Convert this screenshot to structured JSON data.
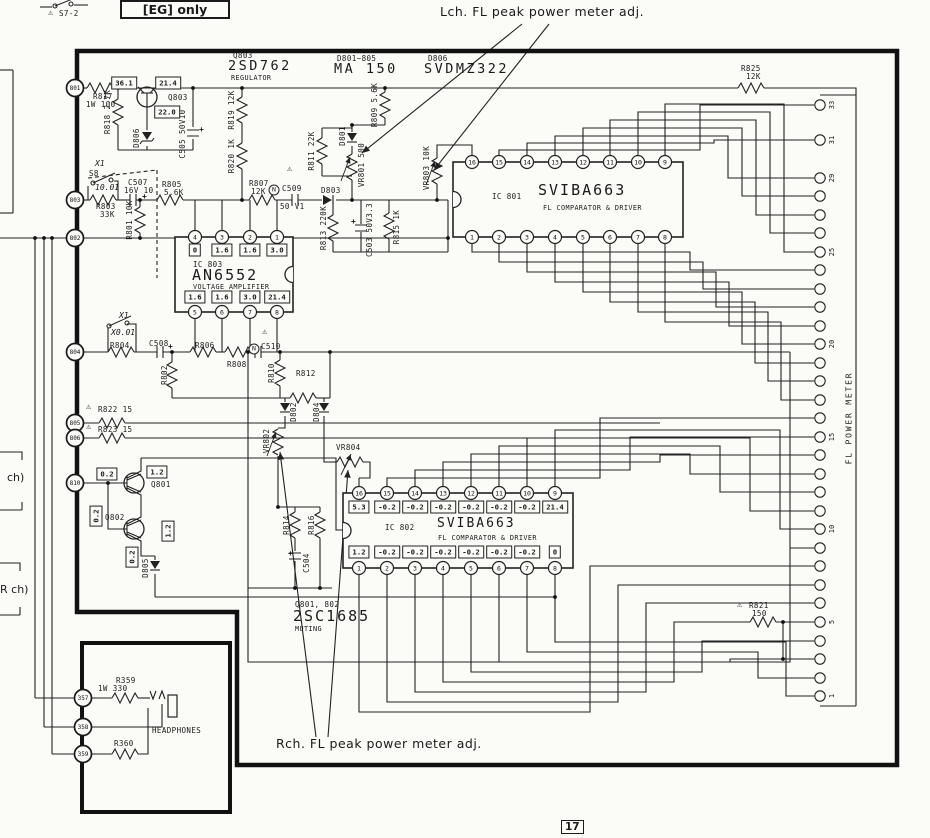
{
  "annotations": {
    "lch": "Lch. FL peak power meter adj.",
    "rch": "Rch. FL peak power meter adj.",
    "eg_only": "[EG] only",
    "page": "17"
  },
  "labels": [
    {
      "t": "⚠",
      "x": 48,
      "y": 9,
      "c": "w",
      "n": "warn-s7-icon"
    },
    {
      "t": "S7-2",
      "x": 59,
      "y": 10,
      "c": "s",
      "n": "switch-s7-2-label"
    },
    {
      "t": "Q803",
      "x": 233,
      "y": 52,
      "c": "s",
      "n": "q803-ref"
    },
    {
      "t": "2SD762",
      "x": 228,
      "y": 59,
      "c": "b1",
      "n": "q803-part"
    },
    {
      "t": "REGULATOR",
      "x": 231,
      "y": 75,
      "c": "xs",
      "n": "q803-function"
    },
    {
      "t": "D801~805",
      "x": 337,
      "y": 55,
      "c": "s",
      "n": "d801-805-ref"
    },
    {
      "t": "MA 150",
      "x": 334,
      "y": 62,
      "c": "b1",
      "n": "d801-805-part"
    },
    {
      "t": "D806",
      "x": 428,
      "y": 55,
      "c": "s",
      "n": "d806-ref"
    },
    {
      "t": "SVDMZ322",
      "x": 424,
      "y": 62,
      "c": "b1",
      "n": "d806-part"
    },
    {
      "t": "R825",
      "x": 741,
      "y": 65,
      "c": "s"
    },
    {
      "t": "12K",
      "x": 746,
      "y": 73,
      "c": "s"
    },
    {
      "t": "R817",
      "x": 93,
      "y": 93,
      "c": "s"
    },
    {
      "t": "1W 100",
      "x": 86,
      "y": 101,
      "c": "s"
    },
    {
      "t": "Q803",
      "x": 168,
      "y": 94,
      "c": "s"
    },
    {
      "t": "R818 2.7K",
      "x": 108,
      "y": 112,
      "r": 1
    },
    {
      "t": "D806",
      "x": 137,
      "y": 138,
      "r": 1
    },
    {
      "t": "C505 50V10",
      "x": 183,
      "y": 134,
      "r": 1
    },
    {
      "t": "R819 12K",
      "x": 232,
      "y": 110,
      "r": 1
    },
    {
      "t": "R820 1K",
      "x": 232,
      "y": 156,
      "r": 1
    },
    {
      "t": "⚠",
      "x": 287,
      "y": 165,
      "c": "w"
    },
    {
      "t": "R811 22K",
      "x": 312,
      "y": 151,
      "r": 1
    },
    {
      "t": "D801",
      "x": 343,
      "y": 136,
      "r": 1
    },
    {
      "t": "R809 5.6K",
      "x": 375,
      "y": 105,
      "r": 1
    },
    {
      "t": "VR801 500",
      "x": 362,
      "y": 165,
      "r": 1
    },
    {
      "t": "VR803 10K",
      "x": 427,
      "y": 168,
      "r": 1
    },
    {
      "t": "X1",
      "x": 95,
      "y": 160,
      "c": "si"
    },
    {
      "t": "S8",
      "x": 89,
      "y": 170,
      "c": "s"
    },
    {
      "t": "10.01",
      "x": 95,
      "y": 184,
      "c": "si"
    },
    {
      "t": "C507",
      "x": 128,
      "y": 179,
      "c": "s"
    },
    {
      "t": "16V 10",
      "x": 124,
      "y": 187,
      "c": "s"
    },
    {
      "t": "R803",
      "x": 96,
      "y": 203,
      "c": "s"
    },
    {
      "t": "33K",
      "x": 100,
      "y": 211,
      "c": "s"
    },
    {
      "t": "R801 10K",
      "x": 130,
      "y": 220,
      "r": 1
    },
    {
      "t": "R805",
      "x": 162,
      "y": 181,
      "c": "s"
    },
    {
      "t": "5.6K",
      "x": 164,
      "y": 189,
      "c": "s"
    },
    {
      "t": "R807",
      "x": 249,
      "y": 180,
      "c": "s"
    },
    {
      "t": "12K",
      "x": 251,
      "y": 188,
      "c": "s"
    },
    {
      "t": "C509",
      "x": 282,
      "y": 185,
      "c": "s"
    },
    {
      "t": "50 V1",
      "x": 280,
      "y": 203,
      "c": "s"
    },
    {
      "t": "D803",
      "x": 321,
      "y": 187,
      "c": "s"
    },
    {
      "t": "R813 220K",
      "x": 324,
      "y": 228,
      "r": 1
    },
    {
      "t": "C503 50V3.3",
      "x": 370,
      "y": 230,
      "r": 1
    },
    {
      "t": "R815 1K",
      "x": 397,
      "y": 227,
      "r": 1
    },
    {
      "t": "IC 803",
      "x": 193,
      "y": 261,
      "c": "s",
      "n": "ic803-ref"
    },
    {
      "t": "AN6552",
      "x": 192,
      "y": 268,
      "c": "b2",
      "n": "ic803-part"
    },
    {
      "t": "VOLTAGE AMPLIFIER",
      "x": 193,
      "y": 284,
      "c": "xs",
      "n": "ic803-function"
    },
    {
      "t": "X1",
      "x": 119,
      "y": 312,
      "c": "si"
    },
    {
      "t": "X0.01",
      "x": 111,
      "y": 329,
      "c": "si"
    },
    {
      "t": "R804",
      "x": 110,
      "y": 342,
      "c": "s"
    },
    {
      "t": "C508",
      "x": 149,
      "y": 340,
      "c": "s"
    },
    {
      "t": "R806",
      "x": 195,
      "y": 342,
      "c": "s"
    },
    {
      "t": "R808",
      "x": 227,
      "y": 361,
      "c": "s"
    },
    {
      "t": "⚠",
      "x": 262,
      "y": 328,
      "c": "w"
    },
    {
      "t": "C510",
      "x": 261,
      "y": 343,
      "c": "s"
    },
    {
      "t": "R802",
      "x": 165,
      "y": 375,
      "r": 1
    },
    {
      "t": "R810",
      "x": 272,
      "y": 373,
      "r": 1
    },
    {
      "t": "R812",
      "x": 296,
      "y": 370,
      "c": "s"
    },
    {
      "t": "⚠",
      "x": 86,
      "y": 403,
      "c": "w"
    },
    {
      "t": "R822 15",
      "x": 98,
      "y": 406,
      "c": "s"
    },
    {
      "t": "⚠",
      "x": 86,
      "y": 423,
      "c": "w"
    },
    {
      "t": "R823 15",
      "x": 98,
      "y": 426,
      "c": "s"
    },
    {
      "t": "VR802",
      "x": 267,
      "y": 441,
      "r": 1
    },
    {
      "t": "D802",
      "x": 294,
      "y": 412,
      "r": 1
    },
    {
      "t": "D804",
      "x": 317,
      "y": 412,
      "r": 1
    },
    {
      "t": "VR804",
      "x": 336,
      "y": 444,
      "c": "s"
    },
    {
      "t": "Q801",
      "x": 151,
      "y": 481,
      "c": "s"
    },
    {
      "t": "Q802",
      "x": 105,
      "y": 514,
      "c": "s"
    },
    {
      "t": "D805",
      "x": 146,
      "y": 568,
      "r": 1
    },
    {
      "t": "R814",
      "x": 287,
      "y": 525,
      "r": 1
    },
    {
      "t": "R816",
      "x": 312,
      "y": 525,
      "r": 1
    },
    {
      "t": "C504",
      "x": 307,
      "y": 563,
      "r": 1
    },
    {
      "t": "Q801, 802",
      "x": 295,
      "y": 601,
      "c": "s",
      "n": "q801-802-ref"
    },
    {
      "t": "2SC1685",
      "x": 293,
      "y": 609,
      "c": "b2",
      "n": "q801-802-part"
    },
    {
      "t": "MUTING",
      "x": 295,
      "y": 626,
      "c": "xs",
      "n": "q801-802-function"
    },
    {
      "t": "IC 801",
      "x": 492,
      "y": 193,
      "c": "s",
      "n": "ic801-ref"
    },
    {
      "t": "SVIBA663",
      "x": 538,
      "y": 183,
      "c": "b2",
      "n": "ic801-part"
    },
    {
      "t": "FL COMPARATOR & DRIVER",
      "x": 543,
      "y": 205,
      "c": "xs",
      "n": "ic801-function"
    },
    {
      "t": "IC 802",
      "x": 385,
      "y": 524,
      "c": "s",
      "n": "ic802-ref"
    },
    {
      "t": "SVIBA663",
      "x": 437,
      "y": 517,
      "c": "b3",
      "n": "ic802-part"
    },
    {
      "t": "FL COMPARATOR & DRIVER",
      "x": 438,
      "y": 535,
      "c": "xs",
      "n": "ic802-function"
    },
    {
      "t": "⚠",
      "x": 737,
      "y": 601,
      "c": "w"
    },
    {
      "t": "R821",
      "x": 749,
      "y": 602,
      "c": "s"
    },
    {
      "t": "150",
      "x": 752,
      "y": 610,
      "c": "s"
    },
    {
      "t": "R359",
      "x": 116,
      "y": 677,
      "c": "s"
    },
    {
      "t": "1W 330",
      "x": 98,
      "y": 685,
      "c": "s"
    },
    {
      "t": "R360",
      "x": 114,
      "y": 740,
      "c": "s"
    },
    {
      "t": "HEADPHONES",
      "x": 152,
      "y": 727,
      "c": "s",
      "n": "headphones-label"
    },
    {
      "t": "ch)",
      "x": 7,
      "y": 472,
      "c": "a2",
      "n": "lch-partial-label"
    },
    {
      "t": "R ch)",
      "x": 0,
      "y": 584,
      "c": "a2",
      "n": "rch-partial-label"
    }
  ],
  "boxed_values": [
    {
      "t": "36.1",
      "x": 124,
      "y": 83
    },
    {
      "t": "21.4",
      "x": 168,
      "y": 83
    },
    {
      "t": "22.0",
      "x": 167,
      "y": 112
    },
    {
      "t": "0.2",
      "x": 107,
      "y": 474
    },
    {
      "t": "1.2",
      "x": 157,
      "y": 472
    },
    {
      "t": "0.2",
      "x": 96,
      "y": 516,
      "rot": 1
    },
    {
      "t": "1.2",
      "x": 168,
      "y": 531,
      "rot": 1
    },
    {
      "t": "0.2",
      "x": 132,
      "y": 557,
      "rot": 1
    }
  ],
  "circle_n_marks": [
    {
      "x": 274,
      "y": 190,
      "t": "N"
    },
    {
      "x": 254,
      "y": 349,
      "t": "N"
    }
  ],
  "plus_marks": [
    [
      142,
      192
    ],
    [
      199,
      125
    ],
    [
      168,
      342
    ],
    [
      351,
      217
    ],
    [
      288,
      549
    ]
  ],
  "left_pins": [
    {
      "id": "801",
      "x": 75,
      "y": 88
    },
    {
      "id": "803",
      "x": 75,
      "y": 200
    },
    {
      "id": "802",
      "x": 75,
      "y": 238
    },
    {
      "id": "804",
      "x": 75,
      "y": 352
    },
    {
      "id": "805",
      "x": 75,
      "y": 423
    },
    {
      "id": "806",
      "x": 75,
      "y": 438
    },
    {
      "id": "810",
      "x": 75,
      "y": 483
    },
    {
      "id": "357",
      "x": 83,
      "y": 698
    },
    {
      "id": "358",
      "x": 83,
      "y": 727
    },
    {
      "id": "359",
      "x": 83,
      "y": 754
    }
  ],
  "ics": [
    {
      "id": "ic803",
      "box": [
        175,
        237,
        293,
        312
      ],
      "notch": "right",
      "xs": [
        195,
        222,
        250,
        277
      ],
      "pins_top": [
        "4",
        "3",
        "2",
        "1"
      ],
      "pins_bottom": [
        "5",
        "6",
        "7",
        "8"
      ],
      "vals_top": [
        "0",
        "1.6",
        "1.6",
        "3.0"
      ],
      "vals_bottom": [
        "1.6",
        "1.6",
        "3.0",
        "21.4"
      ],
      "val_y_top": 250,
      "val_y_bottom": 297
    },
    {
      "id": "ic801",
      "box": [
        453,
        162,
        683,
        237
      ],
      "notch": "left",
      "xs": [
        472,
        499,
        527,
        555,
        583,
        610,
        638,
        665
      ],
      "pins_top": [
        "16",
        "15",
        "14",
        "13",
        "12",
        "11",
        "10",
        "9"
      ],
      "pins_bottom": [
        "1",
        "2",
        "3",
        "4",
        "5",
        "6",
        "7",
        "8"
      ]
    },
    {
      "id": "ic802",
      "box": [
        343,
        493,
        573,
        568
      ],
      "notch": "left",
      "xs": [
        359,
        387,
        415,
        443,
        471,
        499,
        527,
        555
      ],
      "pins_top": [
        "16",
        "15",
        "14",
        "13",
        "12",
        "11",
        "10",
        "9"
      ],
      "pins_bottom": [
        "1",
        "2",
        "3",
        "4",
        "5",
        "6",
        "7",
        "8"
      ],
      "vals_top": [
        "5.3",
        "-0.2",
        "-0.2",
        "-0.2",
        "-0.2",
        "-0.2",
        "-0.2",
        "21.4"
      ],
      "vals_bottom": [
        "1.2",
        "-0.2",
        "-0.2",
        "-0.2",
        "-0.2",
        "-0.2",
        "-0.2",
        "0"
      ],
      "val_y_top": 507,
      "val_y_bottom": 552
    }
  ],
  "right_connector": {
    "title": "FL POWER METER",
    "x": 820,
    "pins": [
      {
        "y": 105,
        "label": "33"
      },
      {
        "y": 140,
        "label": "31"
      },
      {
        "y": 178,
        "label": "29"
      },
      {
        "y": 196,
        "label": ""
      },
      {
        "y": 215,
        "label": ""
      },
      {
        "y": 233,
        "label": ""
      },
      {
        "y": 252,
        "label": "25"
      },
      {
        "y": 270,
        "label": ""
      },
      {
        "y": 289,
        "label": ""
      },
      {
        "y": 307,
        "label": ""
      },
      {
        "y": 326,
        "label": ""
      },
      {
        "y": 344,
        "label": "20"
      },
      {
        "y": 363,
        "label": ""
      },
      {
        "y": 381,
        "label": ""
      },
      {
        "y": 400,
        "label": ""
      },
      {
        "y": 418,
        "label": ""
      },
      {
        "y": 437,
        "label": "15"
      },
      {
        "y": 455,
        "label": ""
      },
      {
        "y": 474,
        "label": ""
      },
      {
        "y": 492,
        "label": ""
      },
      {
        "y": 511,
        "label": ""
      },
      {
        "y": 529,
        "label": "10"
      },
      {
        "y": 548,
        "label": ""
      },
      {
        "y": 566,
        "label": ""
      },
      {
        "y": 585,
        "label": ""
      },
      {
        "y": 603,
        "label": ""
      },
      {
        "y": 622,
        "label": "5"
      },
      {
        "y": 641,
        "label": ""
      },
      {
        "y": 659,
        "label": ""
      },
      {
        "y": 678,
        "label": ""
      },
      {
        "y": 696,
        "label": "1"
      }
    ]
  }
}
